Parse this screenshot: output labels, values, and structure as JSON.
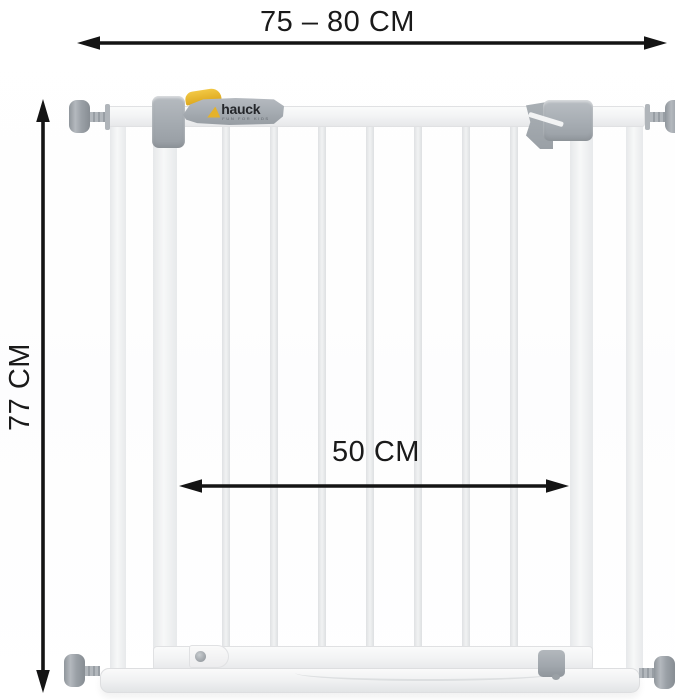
{
  "diagram": {
    "description": "Baby safety gate dimension diagram",
    "brand": {
      "name": "hauck",
      "tagline": "fun for kids"
    },
    "dimensions": {
      "width_range": "75 – 80 CM",
      "height": "77 CM",
      "inner_width": "50 CM"
    },
    "gate": {
      "bar_count": 7,
      "spindle_count": 4
    },
    "colors": {
      "label_text": "#1a1a1a",
      "arrow": "#141414",
      "gate_white": "#f3f4f5",
      "hardware_gray": "#a6abb1",
      "accent_yellow": "#e5b22b",
      "background": "#ffffff"
    }
  }
}
